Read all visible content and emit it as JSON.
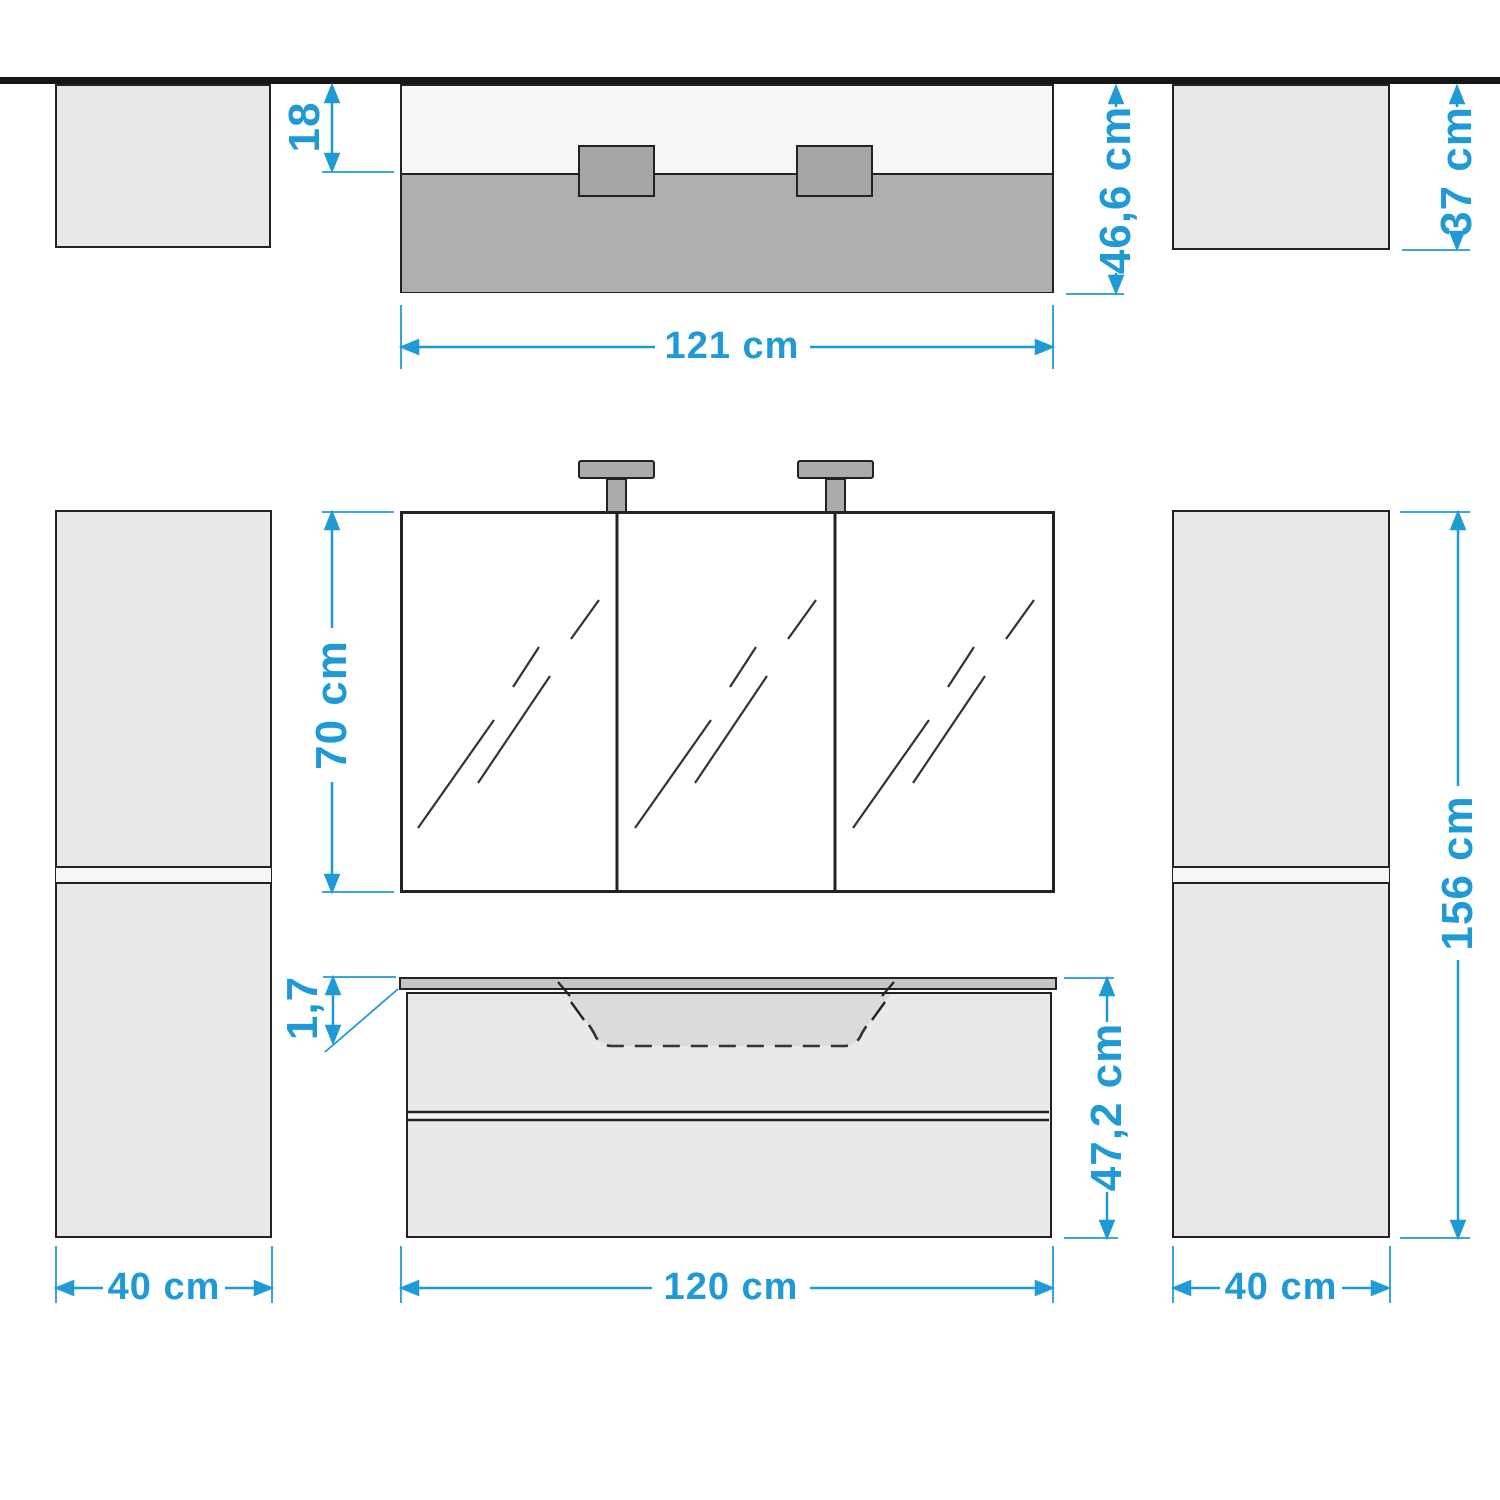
{
  "drawing": {
    "title": "Bathroom furniture set dimension drawing",
    "accent_color": "#1f9ad5",
    "line_color": "#222222",
    "wall_color": "#161616"
  },
  "labels": {
    "mirror_offset_depth": "18",
    "total_depth": "46,6 cm",
    "side_cabinet_depth": "37 cm",
    "set_width_top": "121 cm",
    "mirror_cabinet_height": "70 cm",
    "side_cabinet_height": "156 cm",
    "countertop_thickness": "1,7",
    "vanity_height": "47,2 cm",
    "vanity_width": "120 cm",
    "side_cabinet_width_left": "40 cm",
    "side_cabinet_width_right": "40 cm"
  },
  "components": {
    "wall": "wall line (top view datum)",
    "plan_left_cabinet": "tall side cabinet, top view",
    "plan_vanity_mirror": "vanity with mirror cabinet, top view",
    "plan_right_cabinet": "tall side cabinet, top view",
    "mirror_cabinet": "3-door mirror cabinet with 2 lamps",
    "left_cabinet": "tall side cabinet, front view",
    "right_cabinet": "tall side cabinet, front view",
    "vanity": "washbasin vanity unit with countertop, basin and 2 drawers"
  }
}
